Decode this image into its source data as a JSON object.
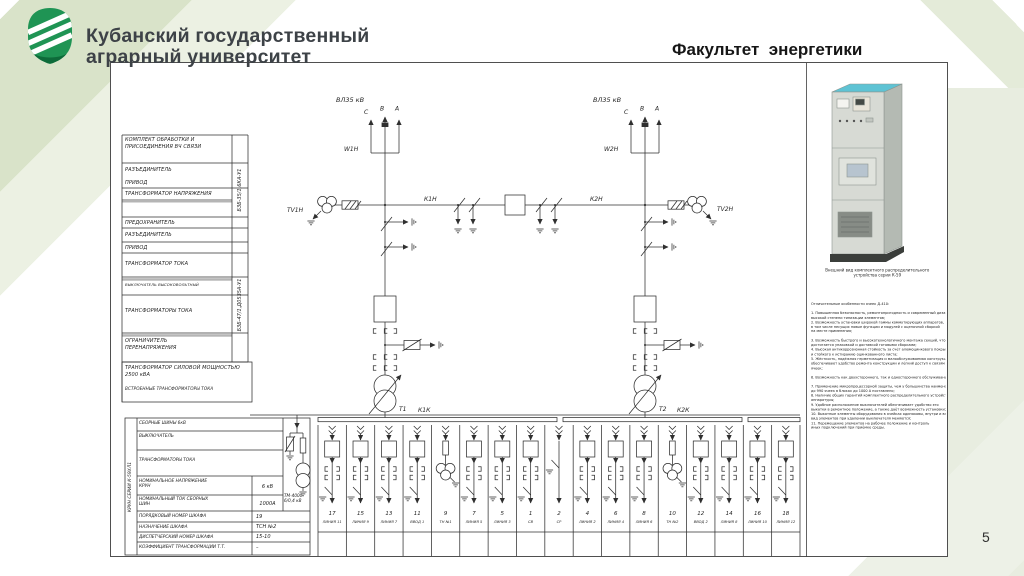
{
  "slide": {
    "university_line1": "Кубанский государственный",
    "university_line2": "аграрный университет",
    "faculty_title": "Факультет  энергетики",
    "page_number": "5"
  },
  "colors": {
    "logo_green": "#1f9454",
    "band_dark": "#d9e3c9",
    "band_light": "#ecf1e3",
    "cabinet_top_cyan": "#5ec3d4"
  },
  "schematic": {
    "labels": {
      "vl_left": "ВЛ35 кВ",
      "vl_right": "ВЛ35 кВ",
      "w1": "W1Н",
      "w2": "W2Н",
      "tv1": "ТV1Н",
      "tv2": "ТV2Н",
      "k1n": "К1Н",
      "k2n": "К2Н",
      "t1": "Т1",
      "t2": "Т2",
      "k1k": "К1К",
      "k2k": "К2К",
      "phase_c": "С",
      "phase_b": "В",
      "phase_a": "А"
    },
    "equipment_table": {
      "rows": [
        "КОМПЛЕКТ ОБРАБОТКИ И ПРИСОЕДИНЕНИЯ ВЧ СВЯЗИ",
        "РАЗЪЕДИНИТЕЛЬ",
        "ПРИВОД",
        "ТРАНСФОРМАТОР НАПРЯЖЕНИЯ",
        "ПРЕДОХРАНИТЕЛЬ",
        "РАЗЪЕДИНИТЕЛЬ",
        "ПРИВОД",
        "ТРАНСФОРМАТОР ТОКА",
        "ВЫКЛЮЧАТЕЛЬ ВЫСОКОВОЛЬТНЫЙ",
        "ТРАНСФОРМАТОРЫ ТОКА",
        "ОГРАНИЧИТЕЛЬ ПЕРЕНАПРЯЖЕНИЯ",
        "ТРАНСФОРМАТОР СИЛОВОЙ МОЩНОСТЬЮ 2500 кВА",
        "ВСТРОЕННЫЕ ТРАНСФОРМАТОРЫ ТОКА"
      ],
      "side_label_top": "БЗБ-35/1,6КА-У1",
      "side_label_bottom": "БЗБ-47/1,Д0535А-У1"
    },
    "krun_table": {
      "side_label": "КРУН СЕРИИ К-59ХЛ1",
      "rows": [
        {
          "label": "СБОРНЫЕ ШИНЫ 6кВ",
          "value": ""
        },
        {
          "label": "ВЫКЛЮЧАТЕЛЬ",
          "value": ""
        },
        {
          "label": "ТРАНСФОРМАТОРЫ ТОКА",
          "value": ""
        },
        {
          "label": "НОМИНАЛЬНОЕ НАПРЯЖЕНИЕ КРУН",
          "value": "6 кВ"
        },
        {
          "label": "НОМИНАЛЬНЫЙ ТОК СБОРНЫХ ШИН",
          "value": "1000А"
        },
        {
          "label": "ПОРЯДКОВЫЙ НОМЕР ШКАФА",
          "value": "19"
        },
        {
          "label": "НАЗНАЧЕНИЕ ШКАФА",
          "value": "ТСН №2"
        },
        {
          "label": "ДИСПЕТЧЕРСКИЙ НОМЕР ШКАФА",
          "value": "15-10"
        },
        {
          "label": "КОЭФФИЦИЕНТ ТРАНСФОРМАЦИИ Т.Т.",
          "value": "–"
        }
      ],
      "transformer_line1": "ТМ-4000",
      "transformer_line2": "6/0,4 кВ"
    },
    "cells": [
      {
        "num": "17",
        "label": "ЛИНИЯ 11",
        "type": "line"
      },
      {
        "num": "15",
        "label": "ЛИНИЯ 9",
        "type": "line"
      },
      {
        "num": "13",
        "label": "ЛИНИЯ 7",
        "type": "line"
      },
      {
        "num": "11",
        "label": "ВВОД 1",
        "type": "line"
      },
      {
        "num": "9",
        "label": "ТН №1",
        "type": "tn"
      },
      {
        "num": "7",
        "label": "ЛИНИЯ 5",
        "type": "line"
      },
      {
        "num": "5",
        "label": "ЛИНИЯ 3",
        "type": "line"
      },
      {
        "num": "1",
        "label": "СВ",
        "type": "line"
      },
      {
        "num": "2",
        "label": "СР",
        "type": "sr"
      },
      {
        "num": "4",
        "label": "ЛИНИЯ 2",
        "type": "line"
      },
      {
        "num": "6",
        "label": "ЛИНИЯ 4",
        "type": "line"
      },
      {
        "num": "8",
        "label": "ЛИНИЯ 6",
        "type": "line"
      },
      {
        "num": "10",
        "label": "ТН №2",
        "type": "tn"
      },
      {
        "num": "12",
        "label": "ВВОД 2",
        "type": "line"
      },
      {
        "num": "14",
        "label": "ЛИНИЯ 8",
        "type": "line"
      },
      {
        "num": "16",
        "label": "ЛИНИЯ 10",
        "type": "line"
      },
      {
        "num": "18",
        "label": "ЛИНИЯ 12",
        "type": "line"
      }
    ]
  },
  "right_panel": {
    "caption_line1": "Внешний вид комплектного распределительного",
    "caption_line2": "устройства серии К-59",
    "text_lines": [
      "Отличительные особенности ячеек Д-410:",
      "",
      "1. Повышенная безопасность, ремонтопригодность и современный дизайн при",
      "высокой степени типизации элементов;",
      "2. Возможность установки широкой гаммы коммутирующих аппаратов,",
      "в том числе несущих новые функции и модулей с оценочной сборкой",
      "на месте применения;",
      "",
      "3. Возможность быстрого и высокотехнологичного монтажа секций, что",
      "достигается упаковкой и доставкой готовыми сборками;",
      "4. Высокая антикоррозионная стойкость за счёт алюмоцинкового покрытия",
      "и стойкого к истиранию оцинкованного листа;",
      "5. Жёсткость, надёжная герметизация и малообслуживаемая конструкция",
      "обеспечивают удобство ремонта конструкции и лёгкий доступ к связям",
      "ячеек;",
      "",
      "6. Возможность как двухстороннего, так и одностороннего обслуживания;",
      "",
      "7. Применение микропроцессорной защиты, чем у большинства наименований,",
      "до 990 ячеек в блоках до 1000 А поставлено;",
      "8. Наличие общих гарантий комплектного распределительного устройства и",
      "аппаратуры;",
      "9. Удобное расположение выключателей обеспечивает удобство его",
      "выкатки в ремонтное положение, а также даёт возможность установки;",
      "10. Выкатные элементы оборудования в ячейках одинаковы, внутри и внешний",
      "вид элементов при удалении выключателя меняются;",
      "11. Перемещение элементов на рабочее положение и контроль",
      "иных подключений при приёмке среды."
    ]
  }
}
